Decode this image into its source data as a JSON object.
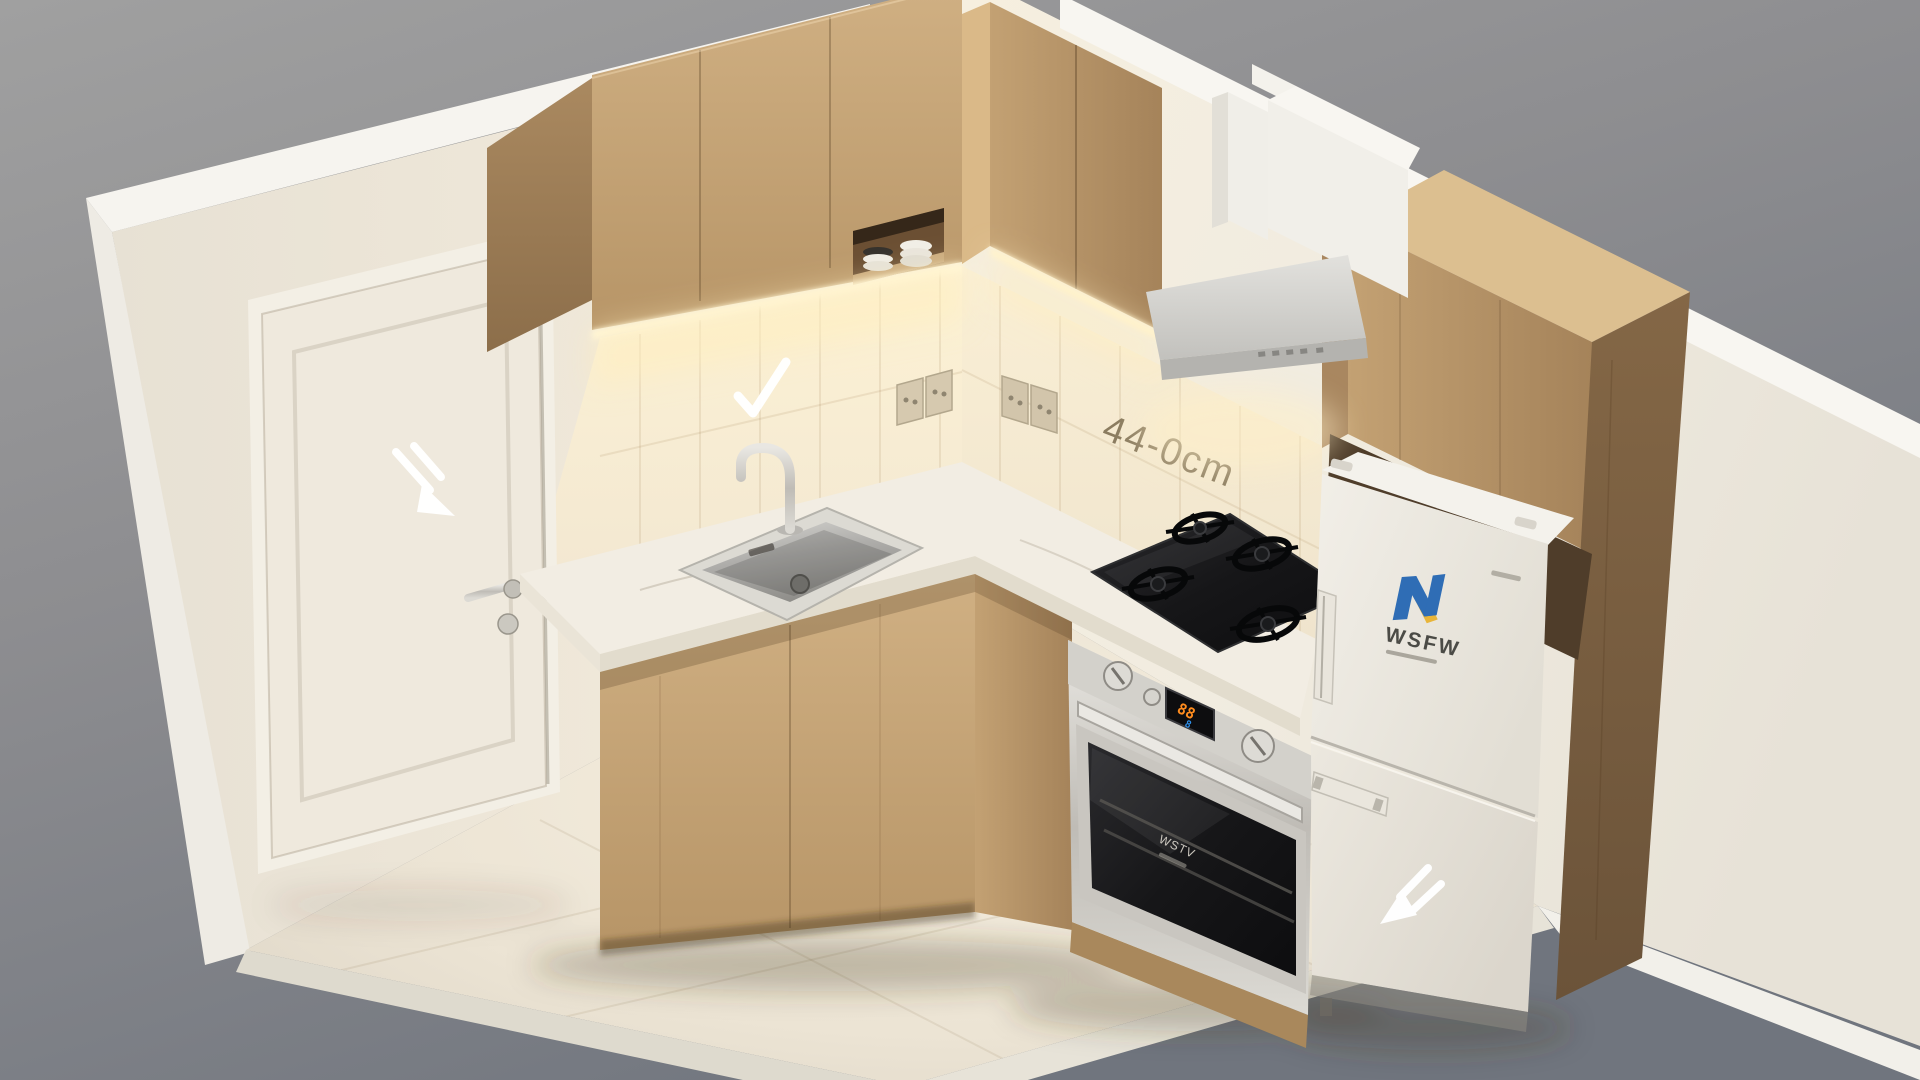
{
  "scene": {
    "title": "Isometric cutaway render of a compact kitchen",
    "annotations": {
      "dimension_label": "44-0cm",
      "checkmark_icon": "checkmark",
      "door_arrow_icon": "arrow-down-right",
      "freezer_arrow_icon": "arrow-down-left"
    },
    "appliances": {
      "fridge": {
        "brand": "WSFW",
        "logo_mark": "N",
        "style": "two-door, bottom freezer"
      },
      "oven": {
        "brand": "WSTV",
        "display_top": "88",
        "display_bottom": "8"
      },
      "cooktop": {
        "burners": 4
      },
      "hood": {
        "style": "wall-mounted pyramid with duct"
      }
    },
    "fixtures": [
      "door",
      "sink",
      "faucet",
      "open shelf with plates",
      "wall outlets",
      "upper cabinets",
      "base cabinets",
      "tall cabinet"
    ],
    "palette": {
      "background_top": "#9e9e9e",
      "background_bottom": "#747983",
      "wall_cream": "#ece6da",
      "wall_white": "#f3efe8",
      "wood_light": "#c8a87a",
      "wood_dark": "#7c6143",
      "counter_marble": "#f2ede3",
      "steel": "#c9c6c0",
      "glass_black": "#17181a",
      "fridge_white": "#efece4",
      "logo_blue": "#2f6db5",
      "logo_yellow": "#e8b53a",
      "display_orange": "#ff8c1e",
      "display_blue": "#2f8fe8",
      "warm_glow": "#ffeec8",
      "dimension_text": "#8b7c60",
      "annotation_white": "#ffffff"
    }
  }
}
